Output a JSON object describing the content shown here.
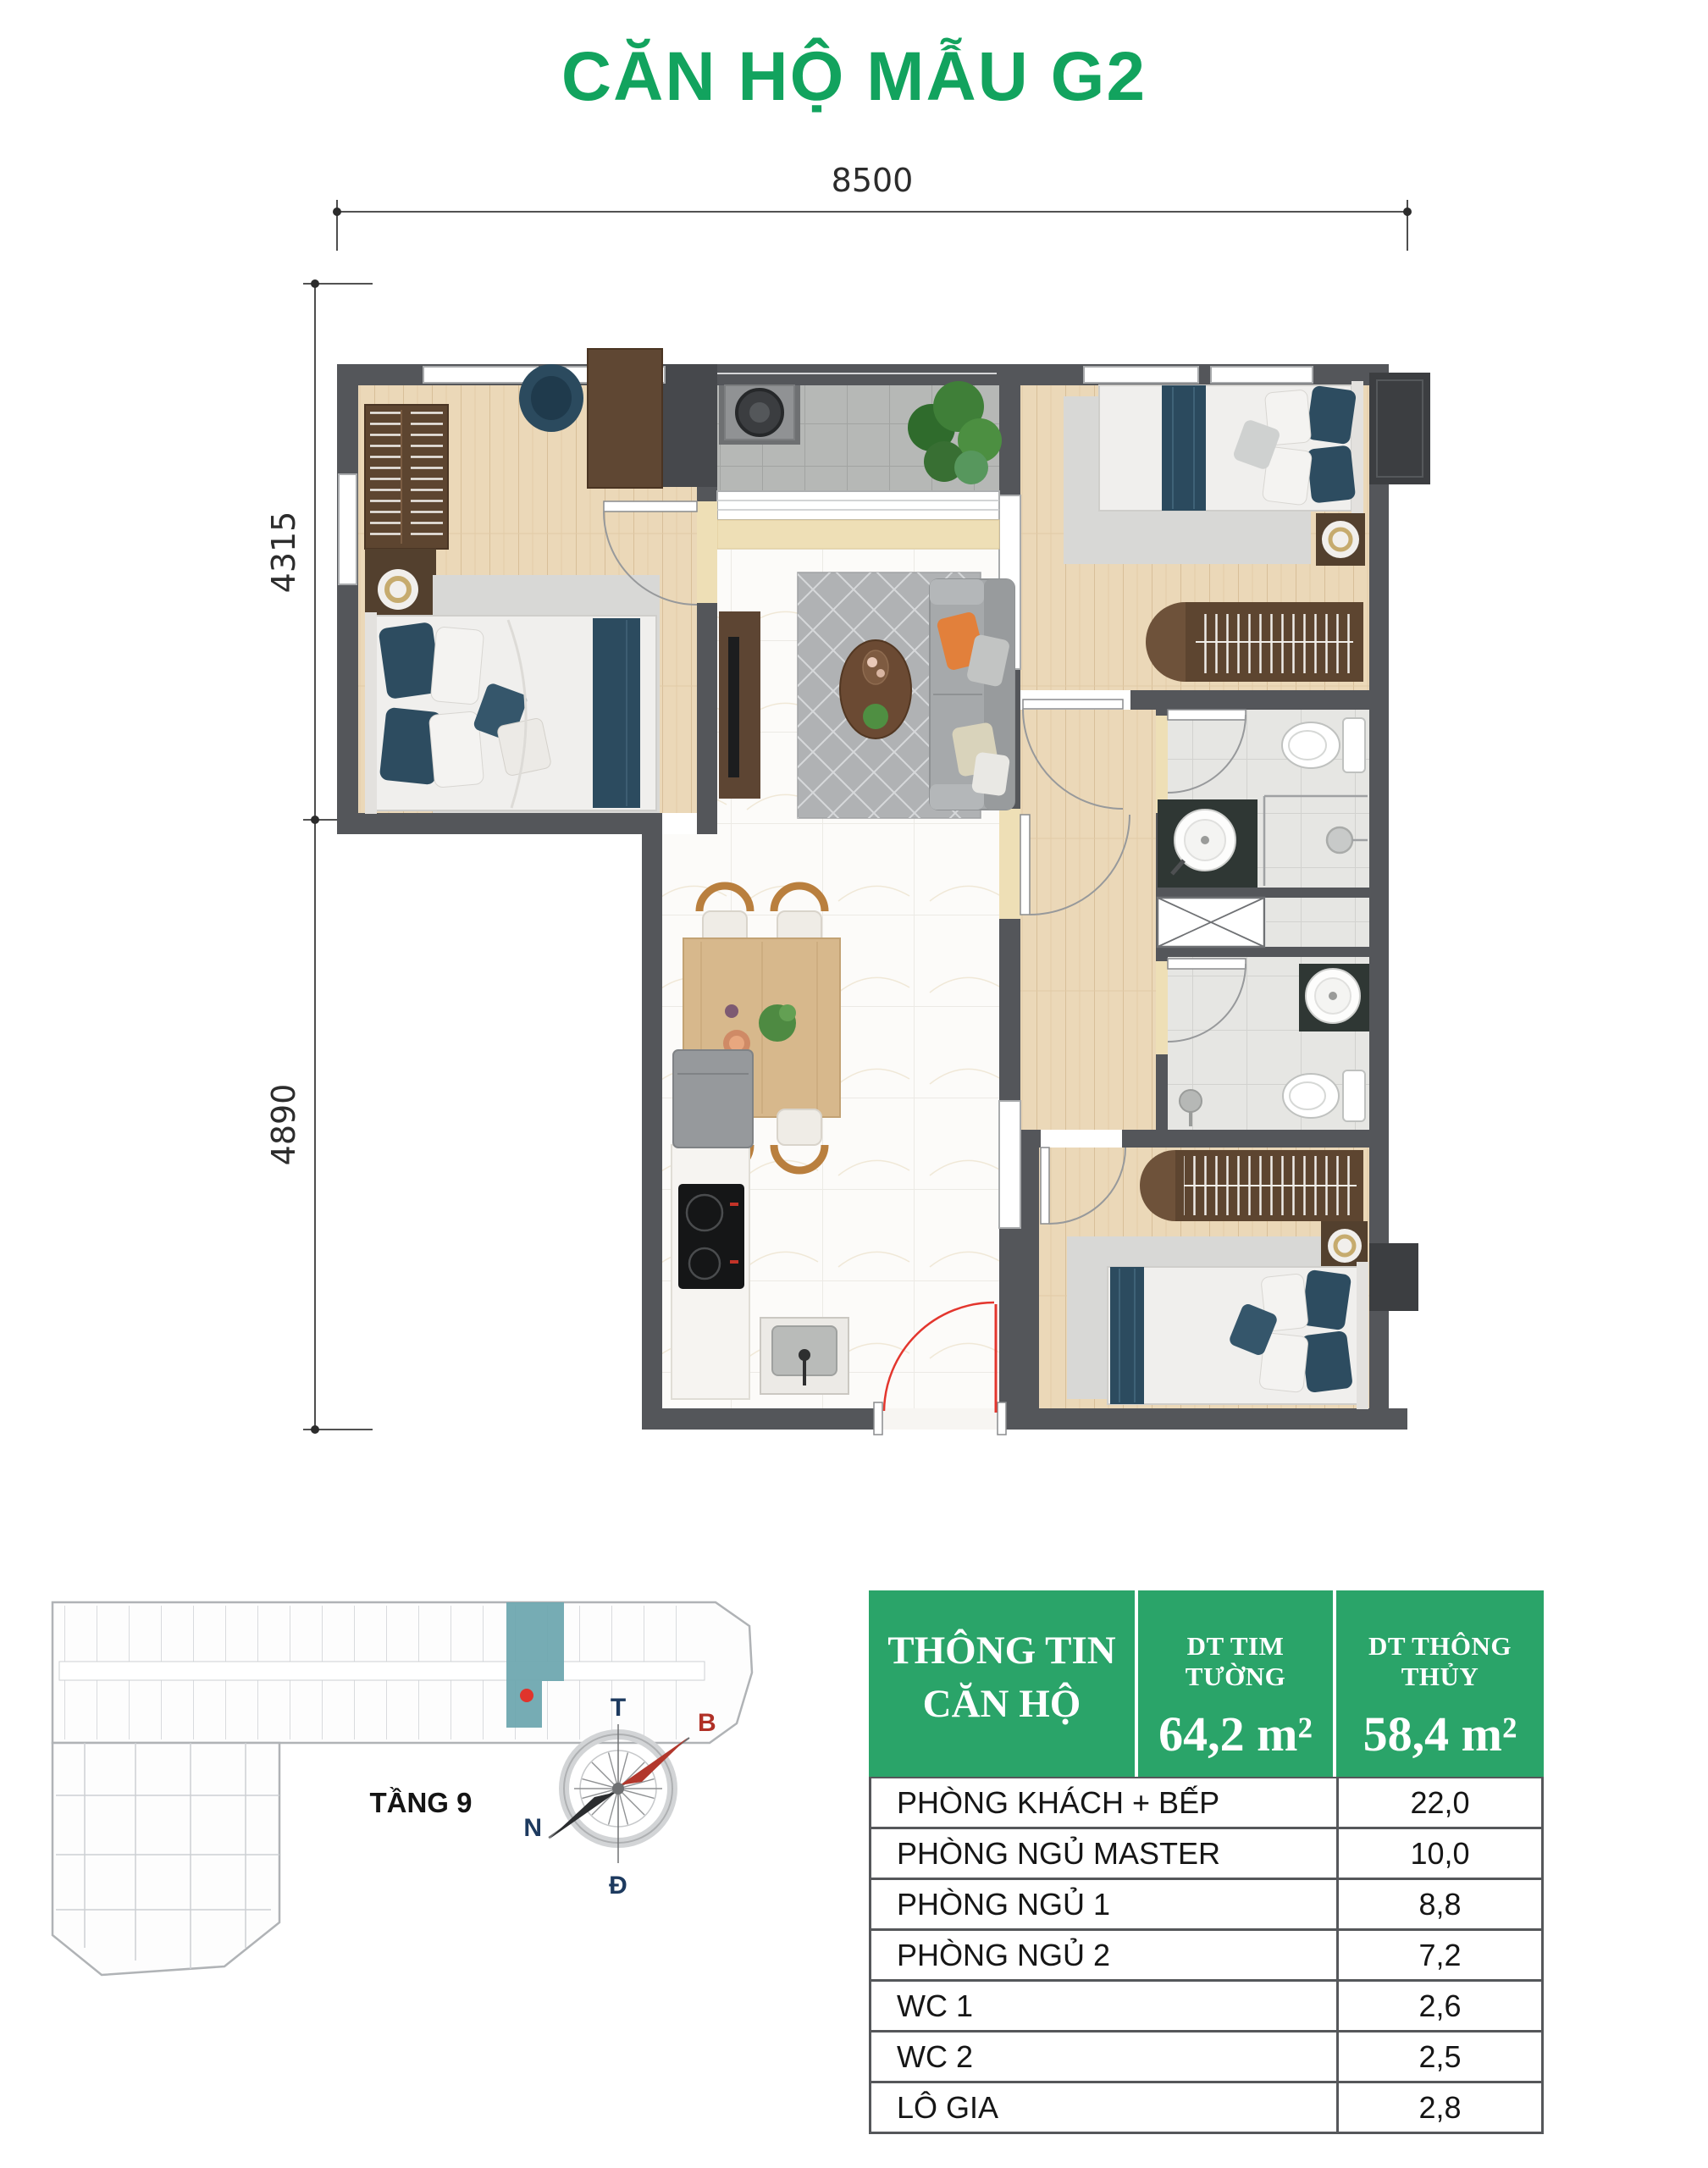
{
  "title": "CĂN HỘ MẪU G2",
  "plan": {
    "dim_width": "8500",
    "dim_height_upper": "4315",
    "dim_height_lower": "4890"
  },
  "site_map": {
    "floor_label": "TẦNG 9",
    "highlight_color": "#6fa8b0",
    "marker_color": "#e0342c"
  },
  "compass": {
    "top": "T",
    "right": "B",
    "left": "N",
    "bottom": "Đ",
    "needle_color": "#b03a2e"
  },
  "info_table": {
    "title": "THÔNG TIN CĂN HỘ",
    "header_bg": "#2aa469",
    "col_walls": {
      "label": "DT TIM TƯỜNG",
      "value": "64,2 m²"
    },
    "col_clear": {
      "label": "DT THÔNG THỦY",
      "value": "58,4 m²"
    },
    "rows": [
      {
        "label": "PHÒNG KHÁCH + BẾP",
        "value": "22,0"
      },
      {
        "label": "PHÒNG NGỦ MASTER",
        "value": "10,0"
      },
      {
        "label": "PHÒNG NGỦ 1",
        "value": "8,8"
      },
      {
        "label": "PHÒNG NGỦ 2",
        "value": "7,2"
      },
      {
        "label": "WC 1",
        "value": "2,6"
      },
      {
        "label": "WC 2",
        "value": "2,5"
      },
      {
        "label": "LÔ GIA",
        "value": "2,8"
      }
    ]
  },
  "colors": {
    "title_green": "#12a35e",
    "wall_gray": "#54565a",
    "wood_floor": "#ebd8b8",
    "entry_door_red": "#e3362e"
  }
}
